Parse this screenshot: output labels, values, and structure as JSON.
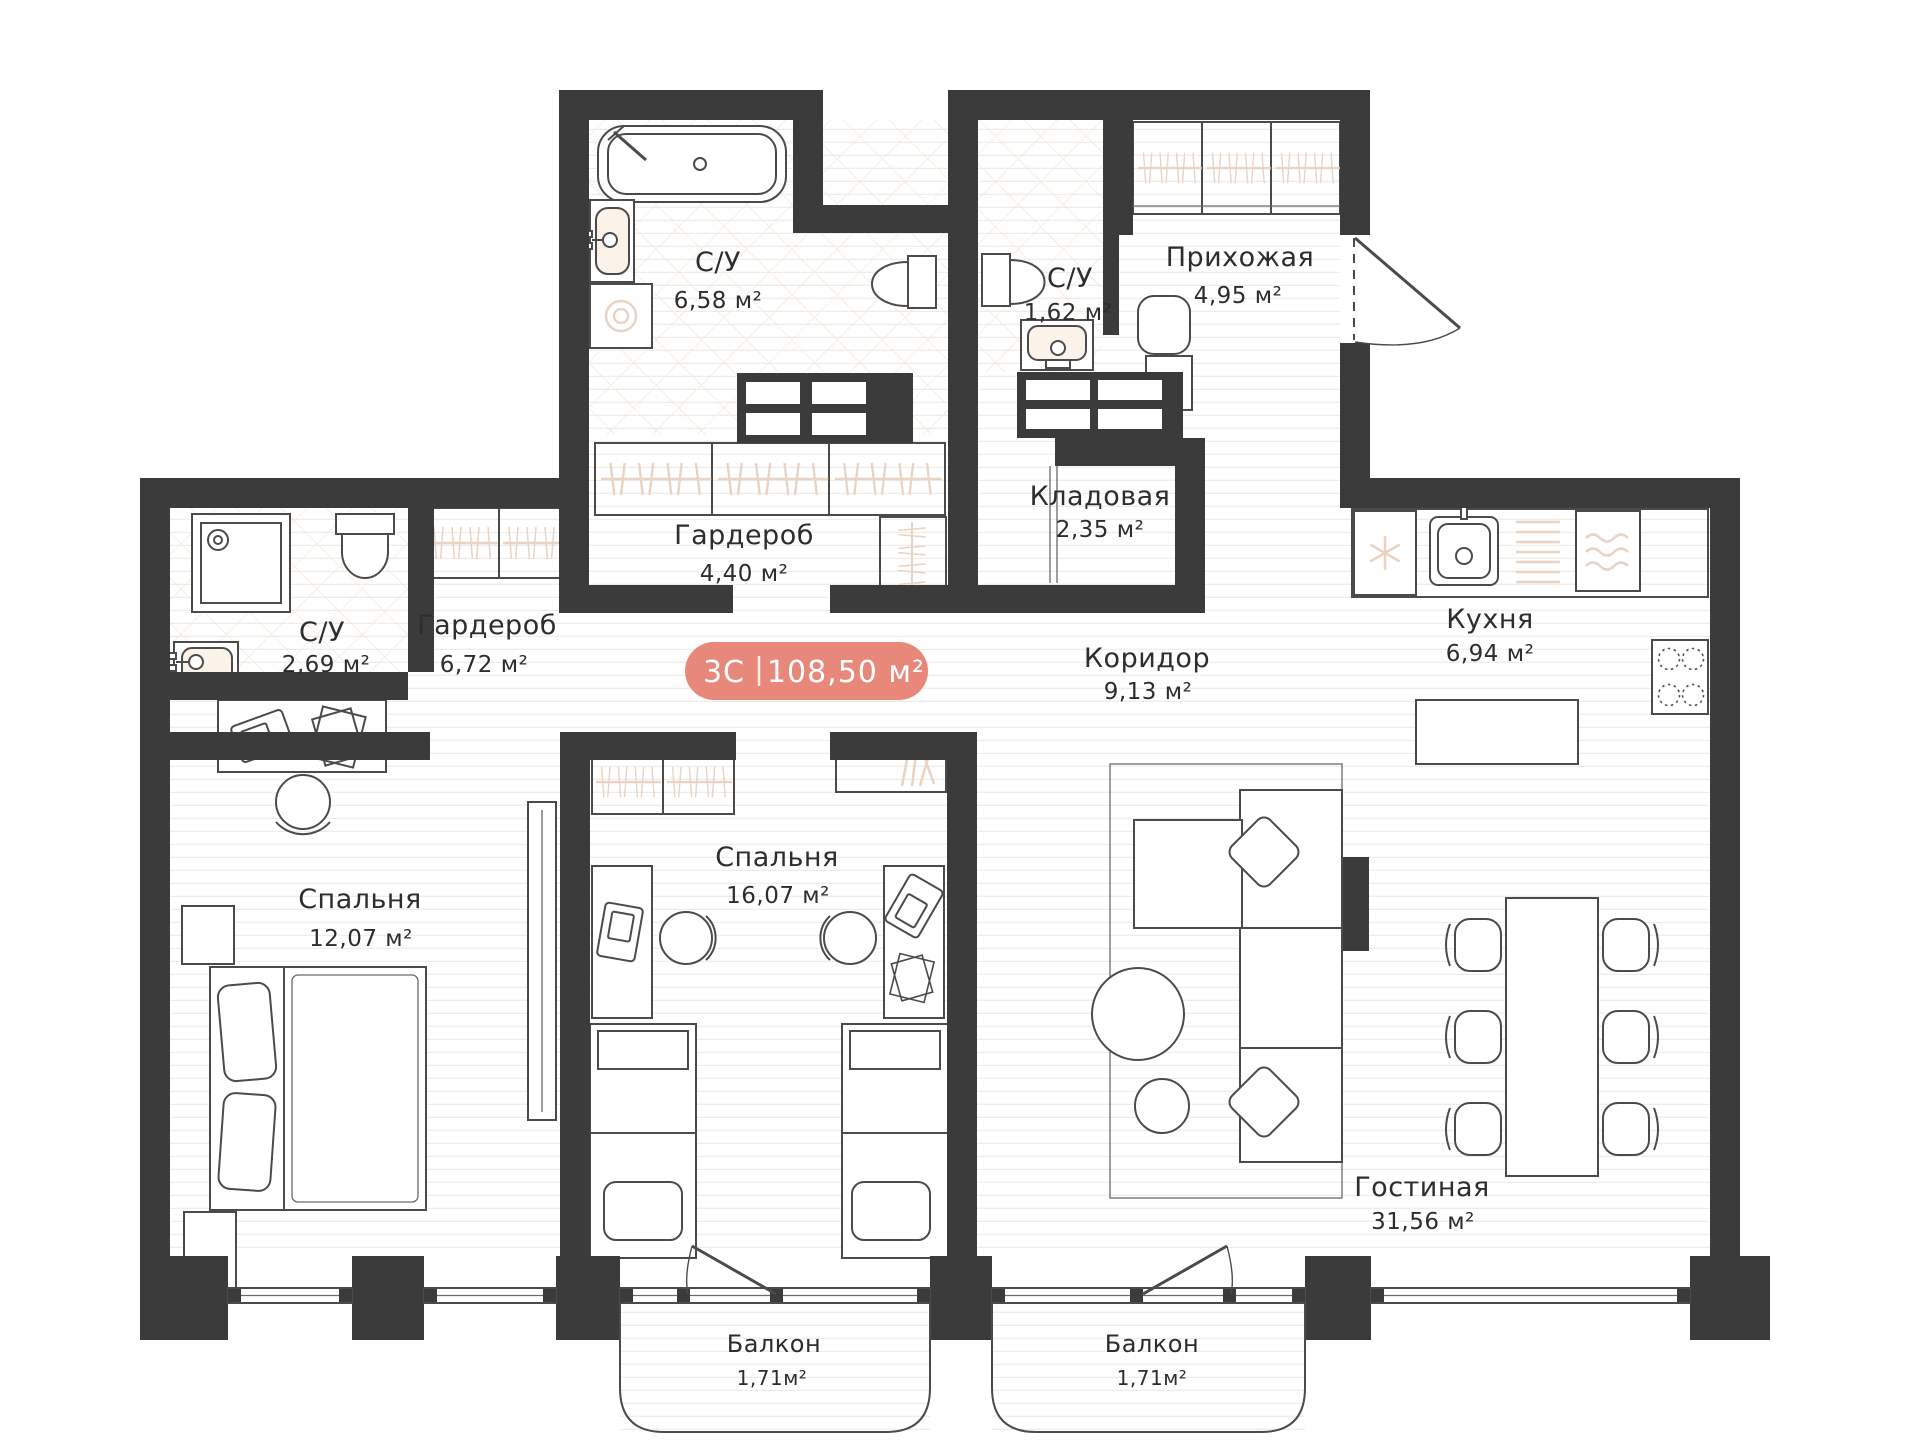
{
  "plan": {
    "badge": {
      "type": "3С",
      "area": "108,50 м²"
    },
    "rooms": [
      {
        "id": "bathroom-main",
        "name": "С/У",
        "area": "6,58 м²"
      },
      {
        "id": "bathroom-small",
        "name": "С/У",
        "area": "1,62 м²"
      },
      {
        "id": "hallway",
        "name": "Прихожая",
        "area": "4,95 м²"
      },
      {
        "id": "storage",
        "name": "Кладовая",
        "area": "2,35 м²"
      },
      {
        "id": "corridor",
        "name": "Коридор",
        "area": "9,13 м²"
      },
      {
        "id": "kitchen",
        "name": "Кухня",
        "area": "6,94 м²"
      },
      {
        "id": "bathroom-left",
        "name": "С/У",
        "area": "2,69 м²"
      },
      {
        "id": "wardrobe-left",
        "name": "Гардероб",
        "area": "6,72 м²"
      },
      {
        "id": "wardrobe-top",
        "name": "Гардероб",
        "area": "4,40 м²"
      },
      {
        "id": "bedroom-1",
        "name": "Спальня",
        "area": "12,07 м²"
      },
      {
        "id": "bedroom-2",
        "name": "Спальня",
        "area": "16,07 м²"
      },
      {
        "id": "living-room",
        "name": "Гостиная",
        "area": "31,56 м²"
      },
      {
        "id": "balcony-1",
        "name": "Балкон",
        "area": "1,71м²"
      },
      {
        "id": "balcony-2",
        "name": "Балкон",
        "area": "1,71м²"
      }
    ],
    "colors": {
      "wall": "#3B3B3B",
      "accent": "#E8887B",
      "beige": "#E9D3C3"
    },
    "icons": [
      "bathtub-icon",
      "sink-icon",
      "washing-machine-icon",
      "toilet-icon",
      "shower-icon",
      "wardrobe-hangers-icon",
      "entrance-door-icon",
      "balcony-door-icon",
      "fridge-snowflake-icon",
      "dishwasher-icon",
      "stove-burners-icon",
      "bed-icon",
      "desk-icon",
      "chair-icon",
      "laptop-icon",
      "sofa-icon",
      "pillow-icon",
      "coffee-table-icon",
      "dining-table-icon",
      "dining-chair-icon",
      "tv-icon",
      "bench-icon",
      "books-icon",
      "window-icon"
    ]
  }
}
